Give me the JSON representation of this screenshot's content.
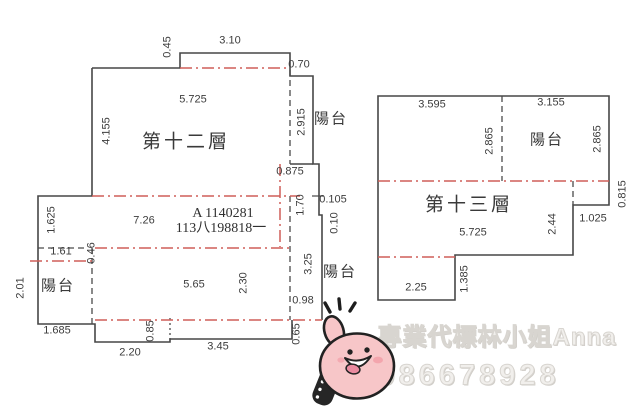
{
  "document": {
    "type": "real-estate-floor-plan",
    "floors": [
      "第十二層",
      "第十三層"
    ],
    "balcony_label": "陽台"
  },
  "id_note": {
    "line1": "A 1140281",
    "line2": "113八198818一"
  },
  "watermark": {
    "line1": "專業代標林小姐Anna",
    "line2": "0986678928"
  },
  "sticker": {
    "icon": "thumbs-up-hand-sticker",
    "pink": "#f7c6c8",
    "outline": "#222222"
  },
  "colors": {
    "wall_line": "#474747",
    "red_dashdot": "#cf5f58",
    "label_text": "#3c3c3c",
    "watermark_gray": "#d8d5d0"
  },
  "labels": [
    {
      "text": "0.45",
      "x": 168,
      "y": 47,
      "kind": "dim rot"
    },
    {
      "text": "3.10",
      "x": 230,
      "y": 41,
      "kind": "dim"
    },
    {
      "text": "0.70",
      "x": 299,
      "y": 65,
      "kind": "dim"
    },
    {
      "text": "5.725",
      "x": 193,
      "y": 100,
      "kind": "dim"
    },
    {
      "text": "第十二層",
      "x": 186,
      "y": 142,
      "kind": "room"
    },
    {
      "text": "4.155",
      "x": 107,
      "y": 131,
      "kind": "dim rot"
    },
    {
      "text": "2.915",
      "x": 302,
      "y": 122,
      "kind": "dim rot"
    },
    {
      "text": "陽台",
      "x": 331,
      "y": 119,
      "kind": "balcony"
    },
    {
      "text": "0.875",
      "x": 290,
      "y": 172,
      "kind": "dim"
    },
    {
      "text": "1.70",
      "x": 301,
      "y": 205,
      "kind": "dim rot"
    },
    {
      "text": "0.105",
      "x": 333,
      "y": 200,
      "kind": "dim"
    },
    {
      "text": "0.10",
      "x": 335,
      "y": 223,
      "kind": "dim rot"
    },
    {
      "text": "1.625",
      "x": 52,
      "y": 220,
      "kind": "dim rot"
    },
    {
      "text": "7.26",
      "x": 144,
      "y": 221,
      "kind": "dim"
    },
    {
      "text": "1.61",
      "x": 61,
      "y": 252,
      "kind": "dim"
    },
    {
      "text": "0.46",
      "x": 92,
      "y": 253,
      "kind": "dim rot"
    },
    {
      "text": "2.01",
      "x": 21,
      "y": 288,
      "kind": "dim rot"
    },
    {
      "text": "陽台",
      "x": 58,
      "y": 286,
      "kind": "balcony"
    },
    {
      "text": "5.65",
      "x": 194,
      "y": 285,
      "kind": "dim"
    },
    {
      "text": "2.30",
      "x": 244,
      "y": 283,
      "kind": "dim rot"
    },
    {
      "text": "3.25",
      "x": 309,
      "y": 264,
      "kind": "dim rot"
    },
    {
      "text": "陽台",
      "x": 340,
      "y": 272,
      "kind": "balcony"
    },
    {
      "text": "0.98",
      "x": 303,
      "y": 301,
      "kind": "dim"
    },
    {
      "text": "1.685",
      "x": 57,
      "y": 331,
      "kind": "dim"
    },
    {
      "text": "0.85",
      "x": 151,
      "y": 331,
      "kind": "dim rot"
    },
    {
      "text": "2.20",
      "x": 130,
      "y": 353,
      "kind": "dim"
    },
    {
      "text": "3.45",
      "x": 218,
      "y": 347,
      "kind": "dim"
    },
    {
      "text": "0.65",
      "x": 297,
      "y": 334,
      "kind": "dim rot"
    },
    {
      "text": "3.595",
      "x": 432,
      "y": 105,
      "kind": "dim"
    },
    {
      "text": "3.155",
      "x": 551,
      "y": 103,
      "kind": "dim"
    },
    {
      "text": "2.865",
      "x": 490,
      "y": 141,
      "kind": "dim rot"
    },
    {
      "text": "陽台",
      "x": 547,
      "y": 140,
      "kind": "balcony"
    },
    {
      "text": "2.865",
      "x": 598,
      "y": 139,
      "kind": "dim rot"
    },
    {
      "text": "0.815",
      "x": 623,
      "y": 194,
      "kind": "dim rot"
    },
    {
      "text": "第十三層",
      "x": 469,
      "y": 205,
      "kind": "room"
    },
    {
      "text": "5.725",
      "x": 473,
      "y": 233,
      "kind": "dim"
    },
    {
      "text": "2.44",
      "x": 553,
      "y": 224,
      "kind": "dim rot"
    },
    {
      "text": "1.025",
      "x": 593,
      "y": 219,
      "kind": "dim"
    },
    {
      "text": "2.25",
      "x": 416,
      "y": 288,
      "kind": "dim"
    },
    {
      "text": "1.385",
      "x": 465,
      "y": 279,
      "kind": "dim rot"
    }
  ]
}
